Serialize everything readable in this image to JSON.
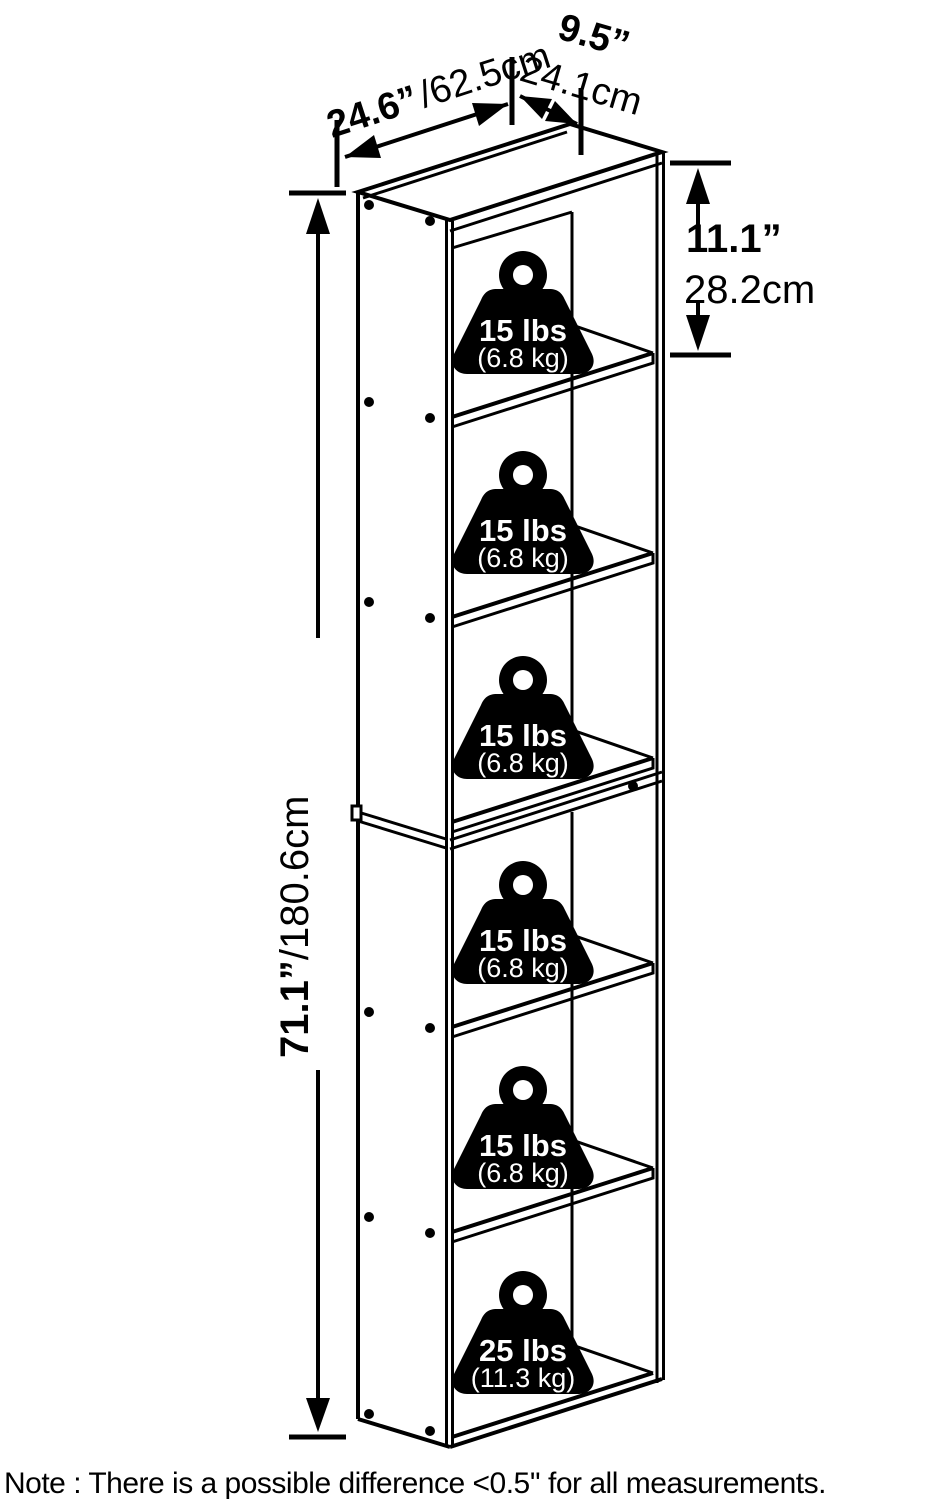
{
  "diagram_title": "bookshelf-6-tier-dimension-diagram",
  "dimensions": {
    "width_in": "24.6”",
    "width_cm": "/62.5cm",
    "depth_in": "9.5”",
    "depth_cm": "24.1cm",
    "compartment_in": "11.1”",
    "compartment_cm": "28.2cm",
    "height_in": "71.1”",
    "height_cm": "/180.6cm"
  },
  "weights": [
    {
      "lbs": "15 lbs",
      "kg": "(6.8 kg)"
    },
    {
      "lbs": "15 lbs",
      "kg": "(6.8 kg)"
    },
    {
      "lbs": "15 lbs",
      "kg": "(6.8 kg)"
    },
    {
      "lbs": "15 lbs",
      "kg": "(6.8 kg)"
    },
    {
      "lbs": "15 lbs",
      "kg": "(6.8 kg)"
    },
    {
      "lbs": "25 lbs",
      "kg": "(11.3 kg)"
    }
  ],
  "note": "Note : There is a possible difference <0.5'' for all measurements.",
  "colors": {
    "line": "#000000",
    "background": "#ffffff",
    "weight_fill": "#000000",
    "weight_text": "#ffffff"
  }
}
